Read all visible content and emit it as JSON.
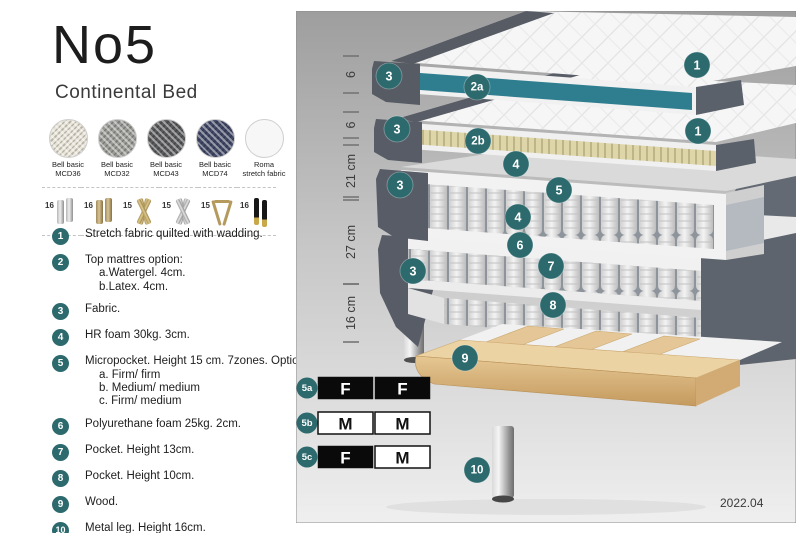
{
  "header": {
    "title": "No5",
    "subtitle": "Continental Bed"
  },
  "fabrics": [
    {
      "line1": "Bell basic",
      "line2": "MCD36",
      "color": "#e9e5d8",
      "weave": true
    },
    {
      "line1": "Bell basic",
      "line2": "MCD32",
      "color": "#9b9b97",
      "weave": true
    },
    {
      "line1": "Bell basic",
      "line2": "MCD43",
      "color": "#595a5c",
      "weave": true
    },
    {
      "line1": "Bell basic",
      "line2": "MCD74",
      "color": "#414866",
      "weave": true
    },
    {
      "line1": "Roma",
      "line2": "stretch fabric",
      "color": "#f7f7f7",
      "weave": false
    }
  ],
  "legs": [
    {
      "height": "16",
      "type": "cylinder-chrome"
    },
    {
      "height": "16",
      "type": "cylinder-brass"
    },
    {
      "height": "15",
      "type": "cross-gold"
    },
    {
      "height": "15",
      "type": "cross-silver"
    },
    {
      "height": "15",
      "type": "hairpin-gold"
    },
    {
      "height": "16",
      "type": "cylinder-black-gold"
    }
  ],
  "spec_list": [
    {
      "num": "1",
      "lines": [
        "Stretch fabric quilted with wadding."
      ]
    },
    {
      "num": "2",
      "lines": [
        "Top mattres option:",
        "a.Watergel. 4cm.",
        "b.Latex. 4cm."
      ]
    },
    {
      "num": "3",
      "lines": [
        "Fabric."
      ]
    },
    {
      "num": "4",
      "lines": [
        "HR foam 30kg. 3cm."
      ]
    },
    {
      "num": "5",
      "lines": [
        "Micropocket. Height 15 cm. 7zones. Option:",
        "a. Firm/ firm",
        "b. Medium/ medium",
        "c. Firm/ medium"
      ]
    },
    {
      "num": "6",
      "lines": [
        "Polyurethane foam 25kg. 2cm."
      ]
    },
    {
      "num": "7",
      "lines": [
        "Pocket. Height 13cm."
      ]
    },
    {
      "num": "8",
      "lines": [
        "Pocket. Height 10cm."
      ]
    },
    {
      "num": "9",
      "lines": [
        "Wood."
      ]
    },
    {
      "num": "10",
      "lines": [
        "Metal leg. Height 16cm."
      ]
    }
  ],
  "diagram": {
    "version": "2022.04",
    "ruler": [
      {
        "label": "6",
        "y1": 45,
        "y2": 82
      },
      {
        "label": "6",
        "y1": 101,
        "y2": 127
      },
      {
        "label": "21 cm",
        "y1": 134,
        "y2": 186
      },
      {
        "label": "27 cm",
        "y1": 189,
        "y2": 273
      },
      {
        "label": "16 cm",
        "y1": 273,
        "y2": 331
      }
    ],
    "badges": [
      {
        "label": "1",
        "x": 401,
        "y": 54
      },
      {
        "label": "3",
        "x": 93,
        "y": 65
      },
      {
        "label": "2a",
        "x": 181,
        "y": 76
      },
      {
        "label": "1",
        "x": 402,
        "y": 120
      },
      {
        "label": "3",
        "x": 101,
        "y": 118
      },
      {
        "label": "2b",
        "x": 182,
        "y": 130
      },
      {
        "label": "4",
        "x": 220,
        "y": 153
      },
      {
        "label": "5",
        "x": 263,
        "y": 179
      },
      {
        "label": "3",
        "x": 104,
        "y": 174
      },
      {
        "label": "4",
        "x": 222,
        "y": 206
      },
      {
        "label": "6",
        "x": 224,
        "y": 234
      },
      {
        "label": "3",
        "x": 117,
        "y": 260
      },
      {
        "label": "7",
        "x": 255,
        "y": 255
      },
      {
        "label": "8",
        "x": 257,
        "y": 294
      },
      {
        "label": "9",
        "x": 169,
        "y": 347
      },
      {
        "label": "10",
        "x": 181,
        "y": 459
      }
    ],
    "firmness": [
      {
        "badge": "5a",
        "y": 366,
        "cells": [
          {
            "label": "F",
            "style": "dark"
          },
          {
            "label": "F",
            "style": "dark"
          }
        ]
      },
      {
        "badge": "5b",
        "y": 401,
        "cells": [
          {
            "label": "M",
            "style": "light"
          },
          {
            "label": "M",
            "style": "light"
          }
        ]
      },
      {
        "badge": "5c",
        "y": 435,
        "cells": [
          {
            "label": "F",
            "style": "dark"
          },
          {
            "label": "M",
            "style": "light"
          }
        ]
      }
    ]
  },
  "colors": {
    "badge_teal": "#2d6a6e",
    "watergel_teal": "#2f7e90",
    "dark_fabric": "#575c66",
    "latex_cream": "#ded6a9",
    "wood_tan": "#e4c697",
    "white_fabric": "#f1f1f1",
    "table_black": "#0a0a0a",
    "table_white": "#ffffff"
  }
}
